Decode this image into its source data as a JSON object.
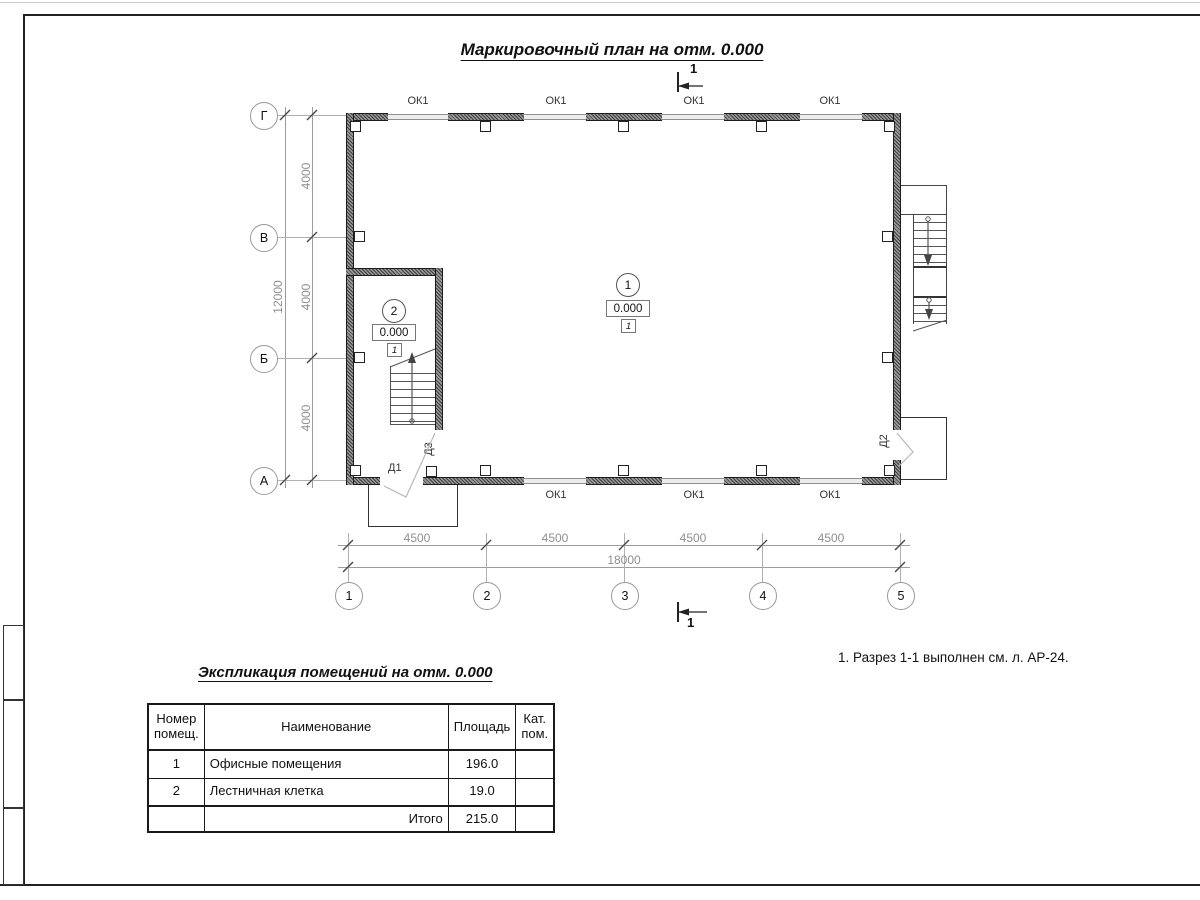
{
  "sheet": {
    "note": "1. Разрез 1-1 выполнен см. л. АР-24."
  },
  "plan": {
    "title": "Маркировочный план на отм. 0.000",
    "section": {
      "label": "1"
    },
    "grid": {
      "rows": [
        "Г",
        "В",
        "Б",
        "А"
      ],
      "cols": [
        "1",
        "2",
        "3",
        "4",
        "5"
      ],
      "row_dims": [
        "4000",
        "4000",
        "4000"
      ],
      "row_total": "12000",
      "col_dims": [
        "4500",
        "4500",
        "4500",
        "4500"
      ],
      "col_total": "18000"
    },
    "windows_top": [
      "ОК1",
      "ОК1",
      "ОК1",
      "ОК1"
    ],
    "windows_bottom": [
      "ОК1",
      "ОК1",
      "ОК1"
    ],
    "doors": {
      "d1": "Д1",
      "d2": "Д2",
      "d3": "Д3"
    },
    "rooms": [
      {
        "number": "1",
        "elevation": "0.000",
        "floor_type": "1"
      },
      {
        "number": "2",
        "elevation": "0.000",
        "floor_type": "1"
      }
    ]
  },
  "table": {
    "title": "Экспликация помещений на отм. 0.000",
    "headers": [
      "Номер помещ.",
      "Наименование",
      "Площадь",
      "Кат. пом."
    ],
    "rows": [
      {
        "number": "1",
        "name": "Офисные помещения",
        "area": "196.0",
        "cat": ""
      },
      {
        "number": "2",
        "name": "Лестничная клетка",
        "area": "19.0",
        "cat": ""
      }
    ],
    "total_label": "Итого",
    "total_area": "215.0"
  }
}
